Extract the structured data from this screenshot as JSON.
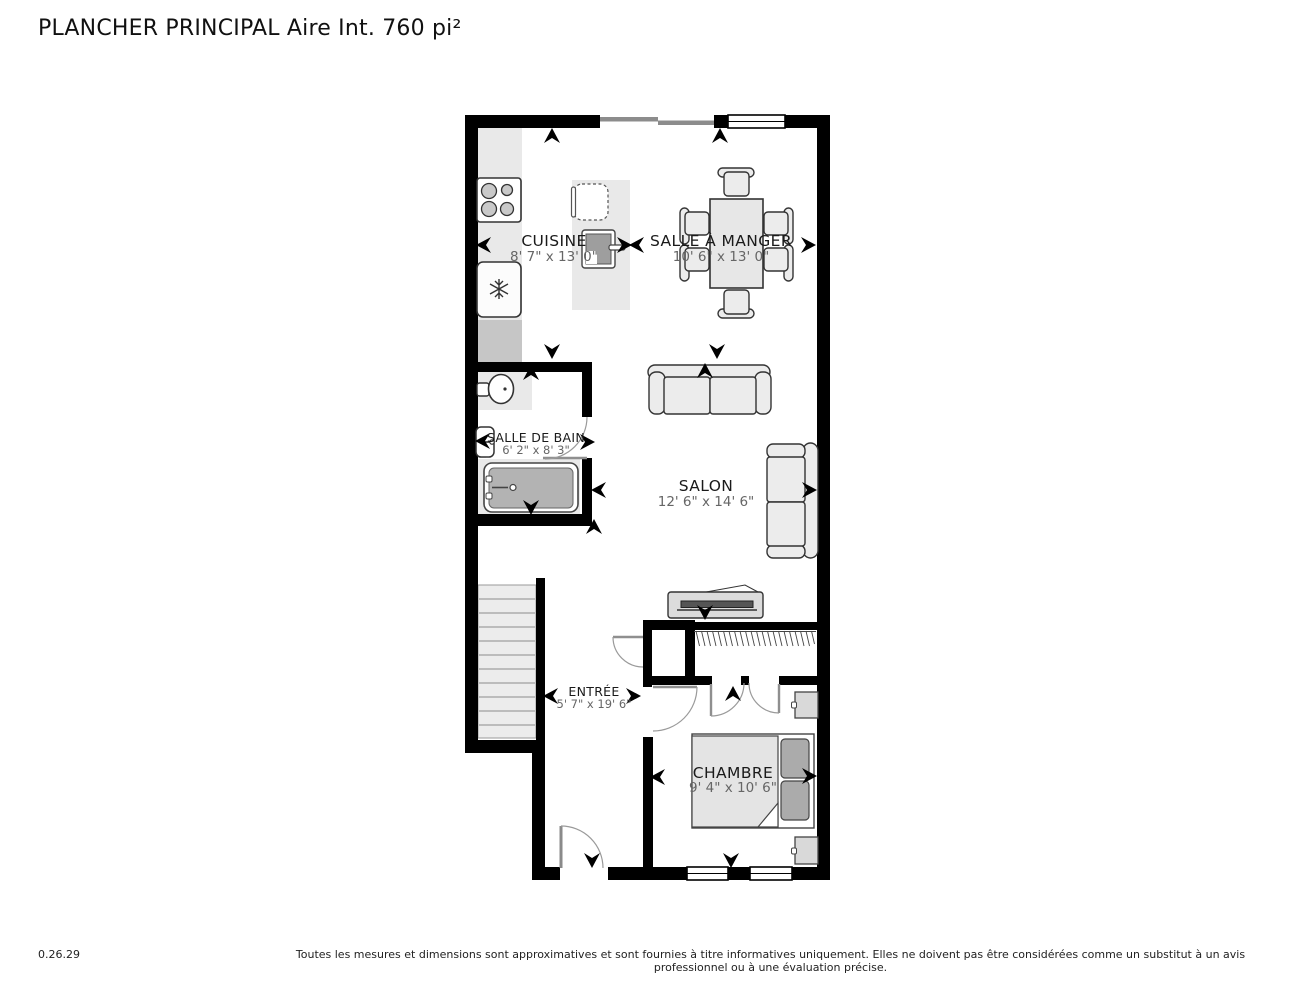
{
  "title": "PLANCHER PRINCIPAL Aire Int. 760 pi²",
  "footer": {
    "version": "0.26.29",
    "disclaimer": "Toutes les mesures et dimensions sont approximatives et sont fournies à titre informatives uniquement. Elles ne doivent pas être considérées comme un substitut à un avis professionnel ou à une évaluation précise."
  },
  "rooms": {
    "cuisine": {
      "name": "CUISINE",
      "dims": "8' 7\" x 13' 0\""
    },
    "salle_a_manger": {
      "name": "SALLE À MANGER",
      "dims": "10' 6\" x 13' 0\""
    },
    "salle_de_bain": {
      "name": "SALLE DE BAIN",
      "dims": "6' 2\" x 8' 3\""
    },
    "salon": {
      "name": "SALON",
      "dims": "12' 6\" x 14' 6\""
    },
    "entree": {
      "name": "ENTRÉE",
      "dims": "5' 7\" x 19' 6\""
    },
    "chambre": {
      "name": "CHAMBRE",
      "dims": "9' 4\" x 10' 6\""
    }
  },
  "colors": {
    "wall": "#000000",
    "counter": "#e9e9e9",
    "appliance_gray": "#c6c6c6",
    "tub": "#b3b3b3",
    "pillow": "#ababab"
  }
}
